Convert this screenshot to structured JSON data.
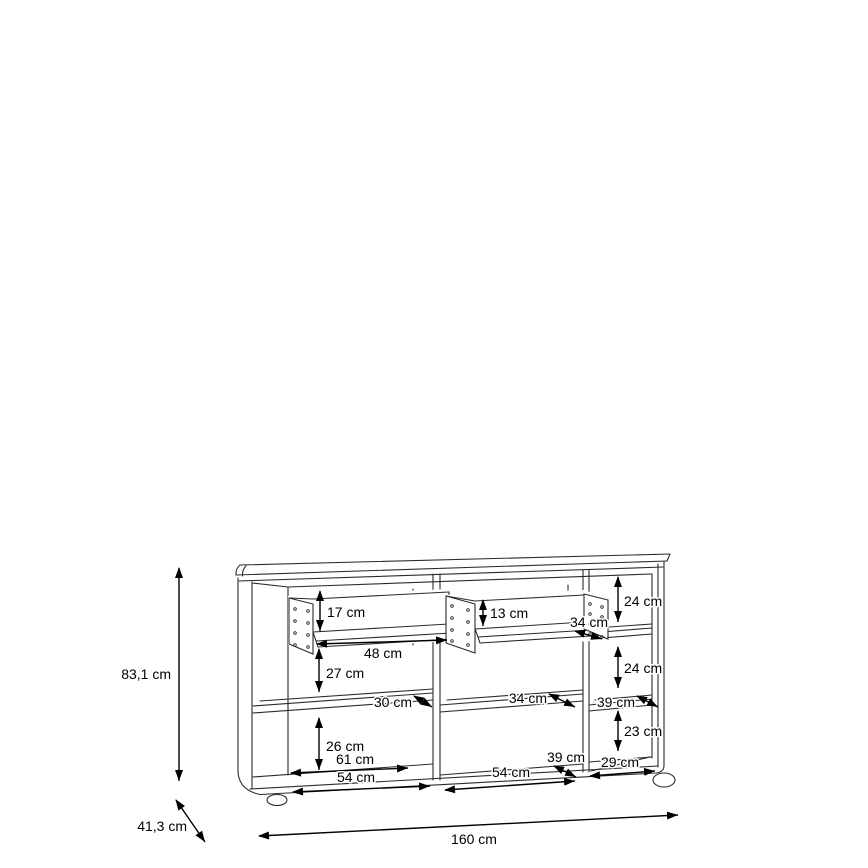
{
  "diagram_type": "furniture dimension drawing (sideboard, front perspective view)",
  "dimensions": {
    "overall_height": "83,1 cm",
    "overall_depth": "41,3 cm",
    "overall_width": "160 cm",
    "drawer_left_inner_height": "17 cm",
    "drawer_left_inner_width": "48 cm",
    "drawer_right_inner_height": "13 cm",
    "drawer_right_inner_depth": "34 cm",
    "right_top_compartment_height": "24 cm",
    "right_middle_compartment_height": "24 cm",
    "left_upper_compartment_height": "27 cm",
    "left_shelf_depth": "30 cm",
    "middle_shelf_depth": "34 cm",
    "right_shelf_depth": "39 cm",
    "left_lower_compartment_height": "26 cm",
    "left_compartment_inner_width": "61 cm",
    "left_bottom_width": "54 cm",
    "middle_bottom_depth": "39 cm",
    "middle_bottom_width": "54 cm",
    "right_lower_compartment_height": "23 cm",
    "right_bottom_width": "29 cm"
  }
}
